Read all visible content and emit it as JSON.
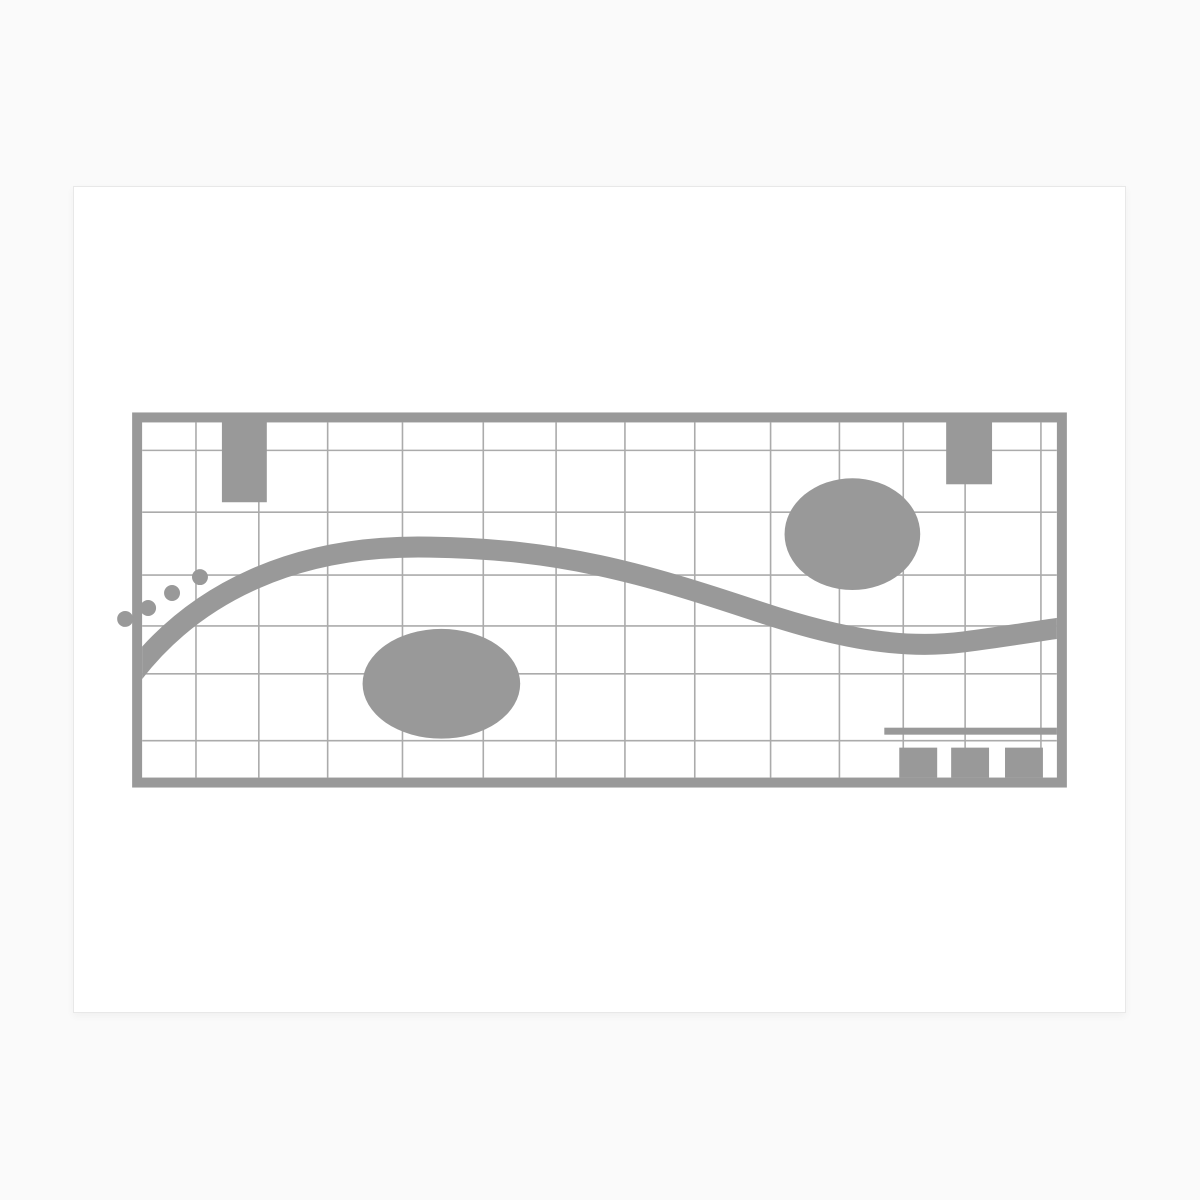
{
  "page": {
    "width": 1200,
    "height": 1200,
    "background_color": "#fafafa"
  },
  "card": {
    "left": 73,
    "top": 186,
    "width": 1053,
    "height": 827,
    "background_color": "#ffffff",
    "border_color": "#e8e8e8"
  },
  "drawing": {
    "ink_color": "#999999",
    "grid_line_color": "#ababab",
    "grid_line_width": 1.6,
    "frame": {
      "x": 58,
      "y": 226,
      "width": 937,
      "height": 376,
      "stroke_width": 10
    },
    "grid": {
      "vertical_x": [
        122,
        185,
        254,
        329,
        410,
        483,
        552,
        622,
        698,
        767,
        831,
        893,
        969
      ],
      "horizontal_y": [
        264,
        326,
        389,
        440,
        488,
        555
      ]
    },
    "tabs": [
      {
        "x": 148,
        "y": 228,
        "width": 45,
        "height": 88
      },
      {
        "x": 874,
        "y": 228,
        "width": 46,
        "height": 70
      }
    ],
    "ellipses": [
      {
        "cx": 780,
        "cy": 348,
        "rx": 68,
        "ry": 56
      },
      {
        "cx": 368,
        "cy": 498,
        "rx": 79,
        "ry": 55
      }
    ],
    "dots": {
      "radius": 8,
      "points": [
        [
          126,
          391
        ],
        [
          98,
          407
        ],
        [
          74,
          422
        ],
        [
          51,
          433
        ]
      ]
    },
    "wave": {
      "stroke_width": 21,
      "path": "M 50 500 C 118 403 227 358 357 361 C 487 363 567 386 687 426 C 777 456 837 463 892 456 C 937 450 967 445 989 442"
    },
    "underline": {
      "x": 812,
      "y": 542,
      "width": 173,
      "height": 7
    },
    "squares": {
      "y": 562,
      "width": 38,
      "height": 30,
      "x_positions": [
        827,
        879,
        933
      ]
    }
  }
}
